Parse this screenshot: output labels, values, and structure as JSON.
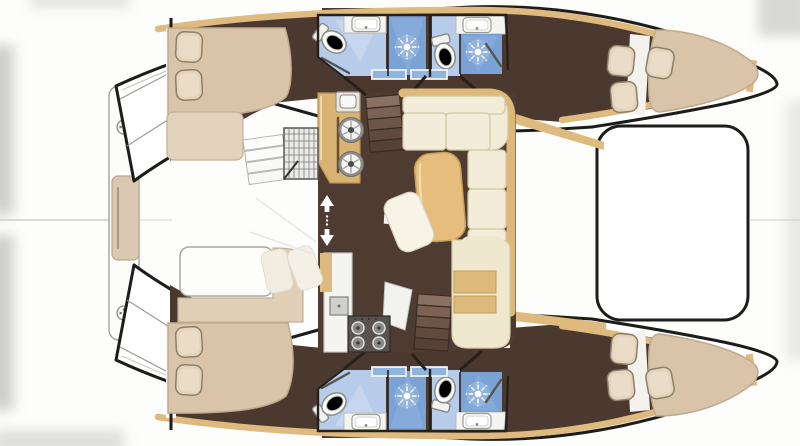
{
  "title": "Catamaran yacht interior layout - top-down floor plan, twin hulls with bows pointing right",
  "diagram": {
    "type": "boat-floor-plan",
    "areas": [
      "aft platform bench between transoms",
      "cockpit",
      "saloon with galley, stove, L-shaped sofa and table",
      "chart desk",
      "foredeck",
      "trampoline between bows",
      "port hull: aft cabin, two bathrooms with showers, forward cabin",
      "starboard hull: aft cabin, two bathrooms with showers, forward cabin"
    ],
    "fixtures": {
      "double_beds": 4,
      "toilets": 4,
      "shower_stalls": 4,
      "sinks": 4,
      "galley_burners": 4,
      "round_basins": 2,
      "companionway_stairs": 2
    }
  },
  "palette": {
    "hull_fill": "#ffffff",
    "hull_outline": "#1c1c1a",
    "interior_brown": "#4b3930",
    "salon_floor": "#4e3c32",
    "wood_trim": "#dfba7e",
    "counter_wood": "#d8b374",
    "bed_beige": "#d9c4aa",
    "pillow_beige": "#e3d4be",
    "sofa_cream": "#f2ecd9",
    "sofa_trim": "#dcb87b",
    "table_wood": "#e6bd7c",
    "bath_floor_blue": "#b7cce9",
    "shower_blue": "#7aa2d5",
    "glass_blue": "#8fb4dd",
    "stove_dark": "#57534e",
    "white_counter": "#f4f4f1",
    "desk_cream": "#f0e7cf",
    "desk_wood": "#ddb97c"
  }
}
